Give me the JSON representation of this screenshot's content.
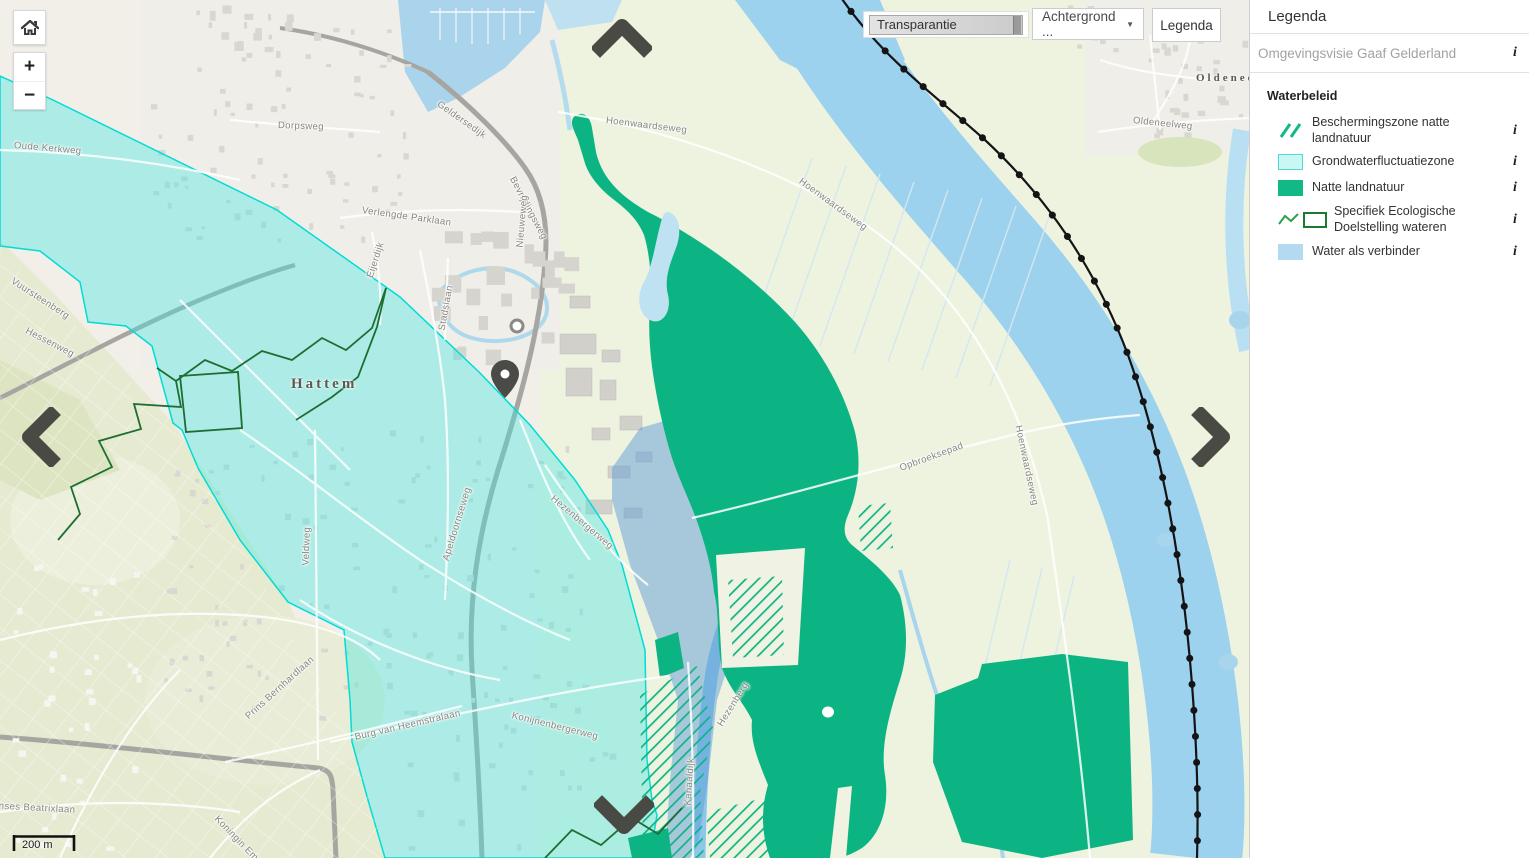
{
  "toolbar": {
    "transparency_label": "Transparantie",
    "background_label": "Achtergrond ...",
    "background_caret": "▼",
    "legend_button_label": "Legenda"
  },
  "controls": {
    "zoom_in": "+",
    "zoom_out": "−",
    "scale_label": "200 m"
  },
  "legend_panel": {
    "title": "Legenda",
    "plan_name": "Omgevingsvisie Gaaf Gelderland",
    "section": "Waterbeleid",
    "info_icon": "i",
    "items": [
      {
        "label": "Beschermingszone natte landnatuur",
        "swatch": "green-hatch"
      },
      {
        "label": "Grondwaterfluctuatiezone",
        "swatch": "cyan-fill"
      },
      {
        "label": "Natte landnatuur",
        "swatch": "green-fill"
      },
      {
        "label": "Specifiek Ecologische Doelstelling wateren",
        "swatch": "zigzag-line-and-outline"
      },
      {
        "label": "Water als verbinder",
        "swatch": "blue-fill"
      }
    ]
  },
  "map": {
    "city_labels": [
      {
        "t": "Hattem",
        "x": 291,
        "y": 376,
        "r": 0,
        "s": 15
      },
      {
        "t": "Oldeneel",
        "x": 1196,
        "y": 72,
        "r": 0,
        "s": 11
      }
    ],
    "street_labels": [
      {
        "t": "Oude Kerkweg",
        "x": 14,
        "y": 140,
        "r": 5
      },
      {
        "t": "Dorpsweg",
        "x": 278,
        "y": 120,
        "r": 2
      },
      {
        "t": "Geldersedijk",
        "x": 438,
        "y": 98,
        "r": 35
      },
      {
        "t": "Bevrijdingsweg",
        "x": 512,
        "y": 172,
        "r": 62
      },
      {
        "t": "Nieuweweg",
        "x": 520,
        "y": 242,
        "r": -85
      },
      {
        "t": "Verlengde Parklaan",
        "x": 362,
        "y": 205,
        "r": 8
      },
      {
        "t": "Eijerdijk",
        "x": 370,
        "y": 272,
        "r": -72
      },
      {
        "t": "Stadslaan",
        "x": 442,
        "y": 325,
        "r": -80
      },
      {
        "t": "Vuursteenberg",
        "x": 12,
        "y": 275,
        "r": 33
      },
      {
        "t": "Hessenweg",
        "x": 26,
        "y": 325,
        "r": 27
      },
      {
        "t": "Veldweg",
        "x": 306,
        "y": 560,
        "r": -88
      },
      {
        "t": "Apeldoornseweg",
        "x": 446,
        "y": 555,
        "r": -73
      },
      {
        "t": "Hezenbergerweg",
        "x": 552,
        "y": 492,
        "r": 40
      },
      {
        "t": "Konijnenbergerweg",
        "x": 512,
        "y": 710,
        "r": 14
      },
      {
        "t": "Burg van Heemstralaan",
        "x": 355,
        "y": 732,
        "r": -13
      },
      {
        "t": "Prins Bernhardlaan",
        "x": 247,
        "y": 712,
        "r": -42
      },
      {
        "t": "Prinses Beatrixlaan",
        "x": -14,
        "y": 800,
        "r": 3
      },
      {
        "t": "Koningin Emmalaan",
        "x": 216,
        "y": 812,
        "r": 46
      },
      {
        "t": "Hoenwaardseweg",
        "x": 606,
        "y": 115,
        "r": 7
      },
      {
        "t": "Hoenwaardseweg",
        "x": 800,
        "y": 175,
        "r": 36
      },
      {
        "t": "Hoenwaardseweg",
        "x": 1018,
        "y": 420,
        "r": 78
      },
      {
        "t": "Opbroeksepad",
        "x": 900,
        "y": 463,
        "r": -20
      },
      {
        "t": "Oldeneelweg",
        "x": 1133,
        "y": 115,
        "r": 6
      },
      {
        "t": "Kanaaldijk",
        "x": 688,
        "y": 800,
        "r": -86
      },
      {
        "t": "Hezenberg",
        "x": 720,
        "y": 720,
        "r": -58
      }
    ]
  },
  "colors": {
    "groundwater_zone_fill": "rgba(64,232,226,0.38)",
    "groundwater_zone_border": "#00dcd6",
    "wet_nature_green": "#0db483",
    "protection_hatch_green": "#0db483",
    "water_connector_blue": "rgba(96,158,214,0.5)",
    "ecological_line_green": "#1d6e33",
    "river_blue": "#9cd2ee",
    "railway_black": "#141414",
    "arrow_gray": "#4a4a45"
  }
}
